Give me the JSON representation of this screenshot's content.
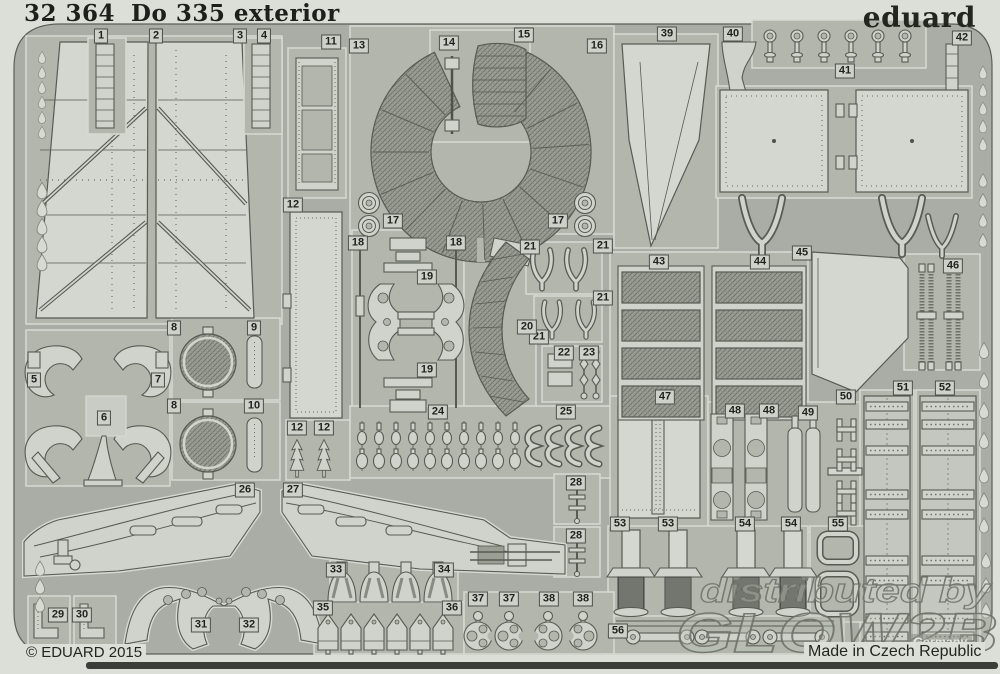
{
  "sheet": {
    "code": "32 364",
    "title": "Do 335 exterior",
    "brand": "eduard",
    "copyright": "© EDUARD 2015",
    "made_in": "Made in Czech Republic"
  },
  "watermark": {
    "line1": "distributed by",
    "line2": "GLOW2B",
    "country": "Germany"
  },
  "colors": {
    "background": "#dcded8",
    "frame": "#a9ada5",
    "cell": "#b2b6ad",
    "part": "#cfd3cb",
    "part_light": "#d4d7d0",
    "outline": "#565b53",
    "mesh": "#9b9f96",
    "dark_detail": "#777b72",
    "text": "#1f221d",
    "shadow": "#3a3d38",
    "watermark": "#6f736b"
  },
  "parts": [
    {
      "n": "1",
      "x": 101,
      "y": 36
    },
    {
      "n": "2",
      "x": 156,
      "y": 36
    },
    {
      "n": "3",
      "x": 240,
      "y": 36
    },
    {
      "n": "4",
      "x": 264,
      "y": 36
    },
    {
      "n": "11",
      "x": 331,
      "y": 42
    },
    {
      "n": "13",
      "x": 359,
      "y": 46
    },
    {
      "n": "14",
      "x": 449,
      "y": 43
    },
    {
      "n": "15",
      "x": 524,
      "y": 35
    },
    {
      "n": "16",
      "x": 597,
      "y": 46
    },
    {
      "n": "39",
      "x": 667,
      "y": 34
    },
    {
      "n": "40",
      "x": 733,
      "y": 34
    },
    {
      "n": "42",
      "x": 962,
      "y": 38
    },
    {
      "n": "41",
      "x": 845,
      "y": 71
    },
    {
      "n": "17",
      "x": 393,
      "y": 221
    },
    {
      "n": "17",
      "x": 558,
      "y": 221
    },
    {
      "n": "12",
      "x": 293,
      "y": 205
    },
    {
      "n": "18",
      "x": 358,
      "y": 243
    },
    {
      "n": "18",
      "x": 456,
      "y": 243
    },
    {
      "n": "19",
      "x": 427,
      "y": 277
    },
    {
      "n": "19",
      "x": 427,
      "y": 370
    },
    {
      "n": "21",
      "x": 530,
      "y": 247
    },
    {
      "n": "21",
      "x": 603,
      "y": 246
    },
    {
      "n": "21",
      "x": 603,
      "y": 298
    },
    {
      "n": "21",
      "x": 539,
      "y": 337
    },
    {
      "n": "20",
      "x": 527,
      "y": 327
    },
    {
      "n": "22",
      "x": 564,
      "y": 353
    },
    {
      "n": "23",
      "x": 589,
      "y": 353
    },
    {
      "n": "24",
      "x": 438,
      "y": 412
    },
    {
      "n": "25",
      "x": 566,
      "y": 412
    },
    {
      "n": "12",
      "x": 297,
      "y": 428
    },
    {
      "n": "12",
      "x": 324,
      "y": 428
    },
    {
      "n": "5",
      "x": 34,
      "y": 380
    },
    {
      "n": "7",
      "x": 158,
      "y": 380
    },
    {
      "n": "6",
      "x": 104,
      "y": 418
    },
    {
      "n": "8",
      "x": 174,
      "y": 328
    },
    {
      "n": "9",
      "x": 254,
      "y": 328
    },
    {
      "n": "8",
      "x": 174,
      "y": 406
    },
    {
      "n": "10",
      "x": 254,
      "y": 406
    },
    {
      "n": "43",
      "x": 659,
      "y": 262
    },
    {
      "n": "44",
      "x": 760,
      "y": 262
    },
    {
      "n": "45",
      "x": 802,
      "y": 253
    },
    {
      "n": "46",
      "x": 953,
      "y": 266
    },
    {
      "n": "47",
      "x": 665,
      "y": 397
    },
    {
      "n": "48",
      "x": 735,
      "y": 411
    },
    {
      "n": "48",
      "x": 769,
      "y": 411
    },
    {
      "n": "49",
      "x": 808,
      "y": 413
    },
    {
      "n": "50",
      "x": 846,
      "y": 397
    },
    {
      "n": "51",
      "x": 903,
      "y": 388
    },
    {
      "n": "52",
      "x": 945,
      "y": 388
    },
    {
      "n": "26",
      "x": 245,
      "y": 490
    },
    {
      "n": "27",
      "x": 293,
      "y": 490
    },
    {
      "n": "28",
      "x": 576,
      "y": 483
    },
    {
      "n": "28",
      "x": 576,
      "y": 536
    },
    {
      "n": "53",
      "x": 620,
      "y": 524
    },
    {
      "n": "53",
      "x": 668,
      "y": 524
    },
    {
      "n": "54",
      "x": 745,
      "y": 524
    },
    {
      "n": "54",
      "x": 791,
      "y": 524
    },
    {
      "n": "55",
      "x": 838,
      "y": 524
    },
    {
      "n": "56",
      "x": 618,
      "y": 631
    },
    {
      "n": "29",
      "x": 58,
      "y": 615
    },
    {
      "n": "30",
      "x": 82,
      "y": 615
    },
    {
      "n": "31",
      "x": 201,
      "y": 625
    },
    {
      "n": "32",
      "x": 249,
      "y": 625
    },
    {
      "n": "33",
      "x": 336,
      "y": 570
    },
    {
      "n": "34",
      "x": 444,
      "y": 570
    },
    {
      "n": "35",
      "x": 323,
      "y": 608
    },
    {
      "n": "36",
      "x": 452,
      "y": 608
    },
    {
      "n": "37",
      "x": 478,
      "y": 599
    },
    {
      "n": "37",
      "x": 509,
      "y": 599
    },
    {
      "n": "38",
      "x": 549,
      "y": 599
    },
    {
      "n": "38",
      "x": 583,
      "y": 599
    }
  ]
}
